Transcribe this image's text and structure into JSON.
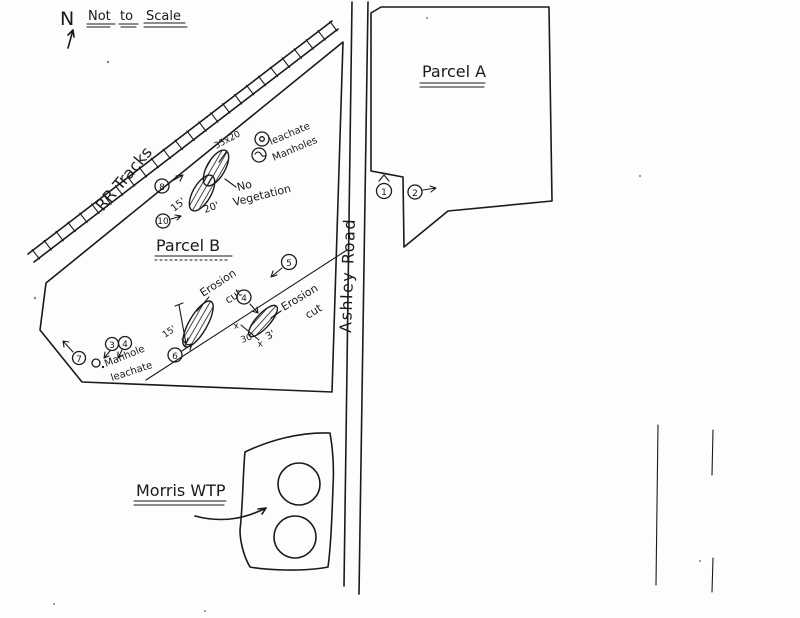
{
  "colors": {
    "ink": "#1a1a1a",
    "paper": "#fdfdfd"
  },
  "compass": {
    "north_label": "N"
  },
  "scale_note": {
    "word1": "Not",
    "word2": "to",
    "word3": "Scale"
  },
  "railroad": {
    "label": "RR Tracks"
  },
  "road": {
    "label": "Ashley Road"
  },
  "parcels": {
    "a_label": "Parcel A",
    "b_label": "Parcel B"
  },
  "wtp": {
    "label": "Morris WTP"
  },
  "mound_area": {
    "dimension": "35x20",
    "leachate_line1": "leachate",
    "leachate_line2": "Manholes",
    "no_veg_line1": "No",
    "no_veg_line2": "Vegetation",
    "width_15": "15'",
    "width_20": "20'"
  },
  "erosion_west": {
    "line1": "Erosion",
    "line2": "cut",
    "depth": "15'"
  },
  "erosion_east": {
    "line1": "Erosion",
    "line2": "cut",
    "dim_30": "30'",
    "dim_3": "3'",
    "x_mark": "x"
  },
  "manhole_south": {
    "symbol": "O.",
    "line1": "Manhole",
    "line2": "leachate"
  },
  "photo_markers": {
    "p1": "1",
    "p2": "2",
    "p3": "3",
    "p4a": "4",
    "p4b": "4",
    "p5": "5",
    "p6": "6",
    "p7": "7",
    "p8": "8",
    "p10": "10"
  }
}
